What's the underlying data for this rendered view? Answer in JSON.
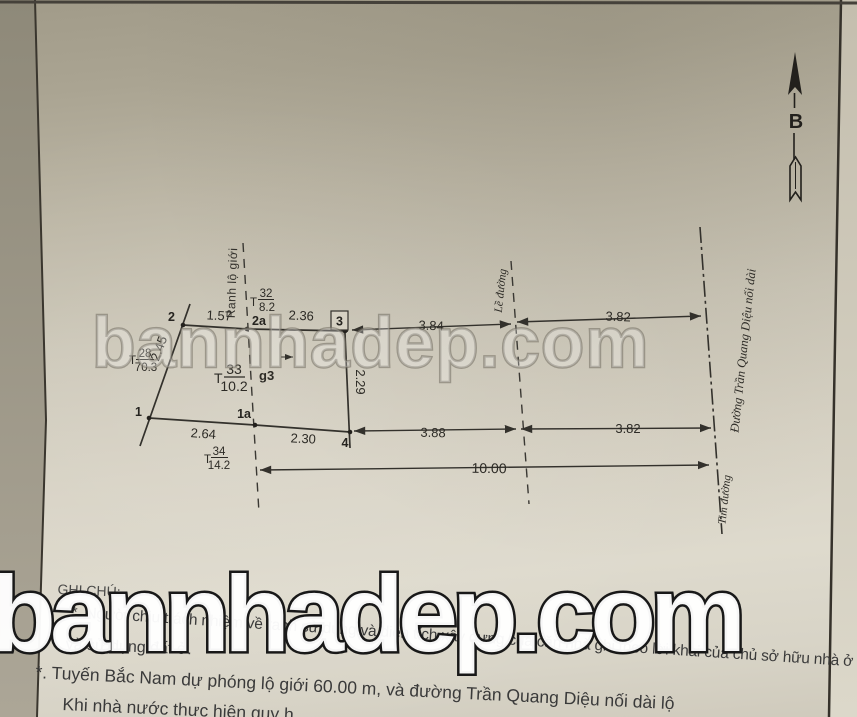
{
  "watermarks": {
    "middle": "bannhadep.com",
    "bottom": "bannhadep.com"
  },
  "compass": {
    "label": "B"
  },
  "diagram": {
    "point_labels": {
      "p1": "1",
      "p1a": "1a",
      "p2": "2",
      "p2a": "2a",
      "p3": "3",
      "p4": "4"
    },
    "dimensions": {
      "top_2_2a": "1.57",
      "top_2a_3": "2.36",
      "left_slant": "2.45",
      "bottom_1_1a": "2.64",
      "bottom_1a_4": "2.30",
      "mid_vertical": "2.29",
      "top_3_curb": "3.84",
      "top_curb_center": "3.82",
      "bottom_4_curb": "3.88",
      "bottom_curb_center": "3.82",
      "overall": "10.00"
    },
    "parcels": {
      "t28": {
        "prefix": "T",
        "no": "28",
        "area": "70.3"
      },
      "t32": {
        "prefix": "T",
        "no": "32",
        "area": "8.2"
      },
      "t33": {
        "prefix": "T",
        "no": "33",
        "area": "10.2"
      },
      "t34": {
        "prefix": "T",
        "no": "34",
        "area": "14.2"
      }
    },
    "structure_label": "g3",
    "line_labels": {
      "road_boundary": "Ranh lộ giới",
      "curb": "Lề đường",
      "road_center": "Tim đường",
      "road_name": "Đường Trần Quang Diệu nối dài"
    }
  },
  "notes": {
    "heading": "GHI CHÚ:",
    "line1": "*. Người chịu trách nhiệm về ranh sử dụng và diện tích xây dựng của căn nhà ghi theo lời khai của chủ sở hữu nhà ở",
    "line2": "và sử dụng đất ở.",
    "line3": "*. Tuyến Bắc Nam dự phóng lộ giới 60.00 m, và đường Trần Quang Diệu nối dài lộ",
    "line4": "Khi nhà nước thực hiện quy h"
  }
}
